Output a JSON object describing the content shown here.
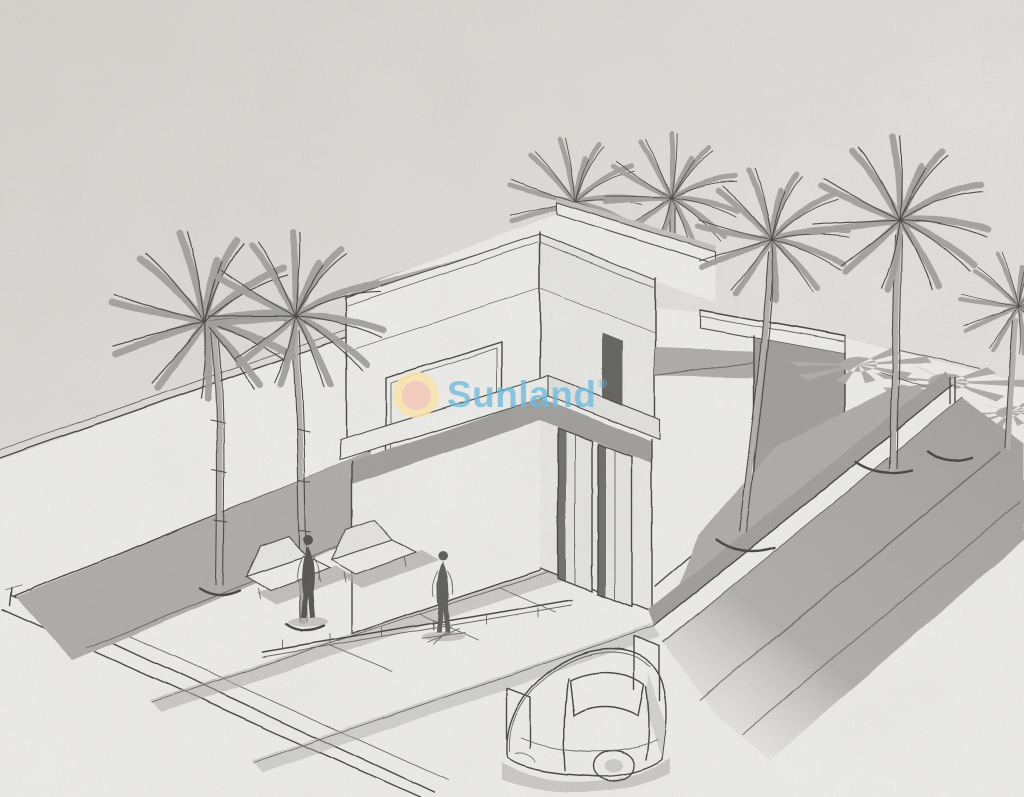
{
  "watermark": {
    "brand": "Sunland",
    "registered_mark": "®",
    "logo_icon": "sun-icon",
    "text_color": "#6fbadc",
    "sun_outer_color": "#f8e2ad",
    "sun_inner_color": "#f2c7b8"
  },
  "palette": {
    "paper": "#ebeae7",
    "sketch_ink": "#3a3a38",
    "shade_gray": "#b2b1af",
    "surface_white": "#fafaf8"
  }
}
